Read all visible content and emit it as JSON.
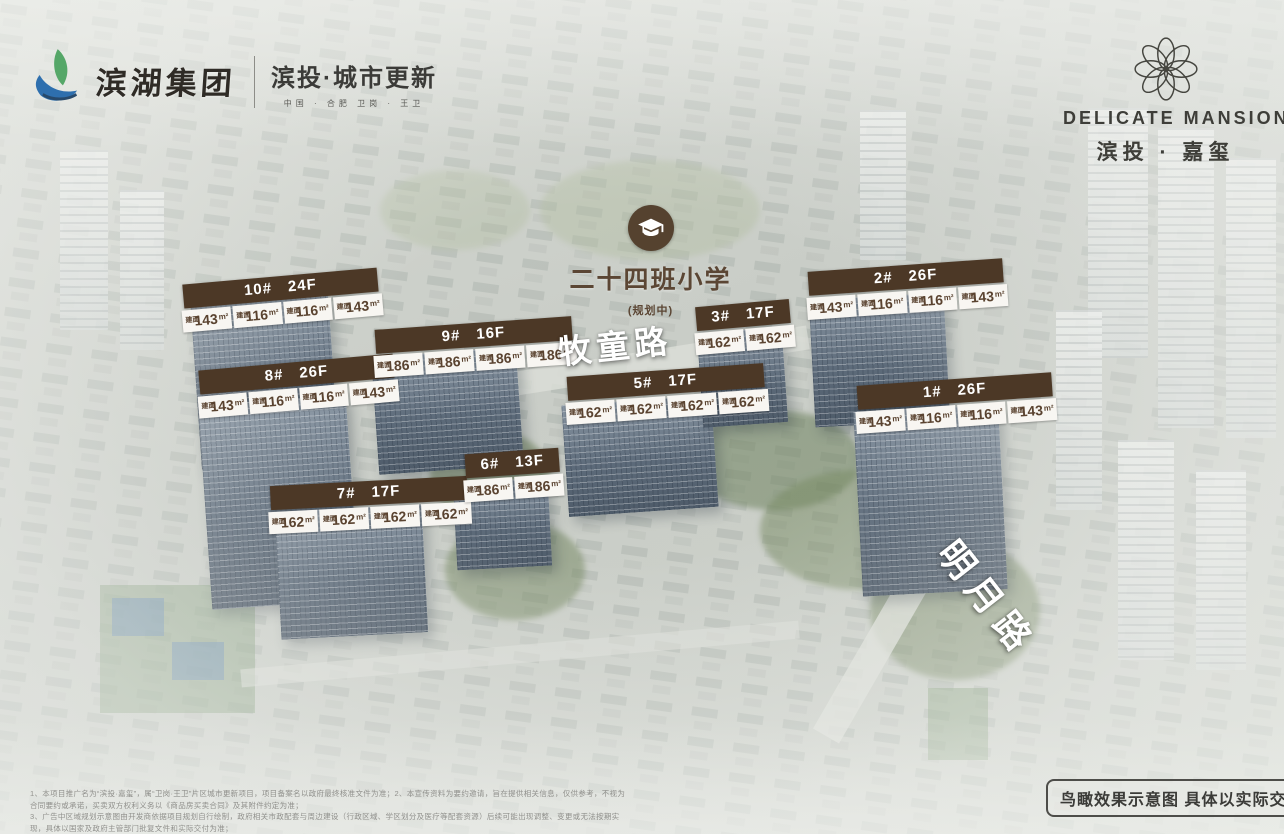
{
  "brand_left": {
    "group_name": "滨湖集团",
    "division": "滨投·城市更新",
    "tagline": "中国 · 合肥    卫岗 · 王卫"
  },
  "brand_right": {
    "name_en": "DELICATE MANSION",
    "name_cn": "滨投 · 嘉玺"
  },
  "school": {
    "icon": "graduation-cap-icon",
    "name": "二十四班小学",
    "status": "(规划中)"
  },
  "roads": [
    {
      "name": "牧童路"
    },
    {
      "name": "明月路"
    }
  ],
  "area_prefix": "建面",
  "area_unit": "m²",
  "buildings": [
    {
      "name": "10#",
      "floors": "24F",
      "units": [
        "143",
        "116",
        "116",
        "143"
      ]
    },
    {
      "name": "8#",
      "floors": "26F",
      "units": [
        "143",
        "116",
        "116",
        "143"
      ]
    },
    {
      "name": "9#",
      "floors": "16F",
      "units": [
        "186",
        "186",
        "186",
        "186"
      ]
    },
    {
      "name": "7#",
      "floors": "17F",
      "units": [
        "162",
        "162",
        "162",
        "162"
      ]
    },
    {
      "name": "6#",
      "floors": "13F",
      "units": [
        "186",
        "186"
      ]
    },
    {
      "name": "5#",
      "floors": "17F",
      "units": [
        "162",
        "162",
        "162",
        "162"
      ]
    },
    {
      "name": "3#",
      "floors": "17F",
      "units": [
        "162",
        "162"
      ]
    },
    {
      "name": "2#",
      "floors": "26F",
      "units": [
        "143",
        "116",
        "116",
        "143"
      ]
    },
    {
      "name": "1#",
      "floors": "26F",
      "units": [
        "143",
        "116",
        "116",
        "143"
      ]
    }
  ],
  "footer": {
    "disclaimer_lines": [
      "1、本项目推广名为“滨投·嘉玺”，属“卫岗·王卫”片区城市更新项目，项目备案名以政府最终核准文件为准；2、本宣传资料为要约邀请，旨在提供相关信息，仅供参考，不视为合同要约或承诺，买卖双方权利义务以《商品房买卖合同》及其附件约定为准；",
      "3、广告中区域规划示意图由开发商依据项目规划自行绘制，政府相关市政配套与周边建设（行政区域、学区划分及医疗等配套资源）后续可能出现调整、变更或无法按期实现，具体以国家及政府主管部门批复文件和实际交付为准；",
      "4、相关教育资源的设置、办学时间与招生政策等非开发商所能控制或保证，具体以政府及学校最终公布信息为准；本公司保留对本宣传资料进行修改的权利，敬请留意最新资料；本资料自开发商为宣传当日印发，不作为要约依据。"
    ],
    "badge": "鸟瞰效果示意图  具体以实际交付为准"
  },
  "colors": {
    "label_brown": "#4c3826",
    "cell_text_brown": "#5a4330",
    "school_brown": "#55422f",
    "road_text": "#ffffff",
    "logo_green": "#55a768",
    "logo_blue": "#2e6fae"
  }
}
